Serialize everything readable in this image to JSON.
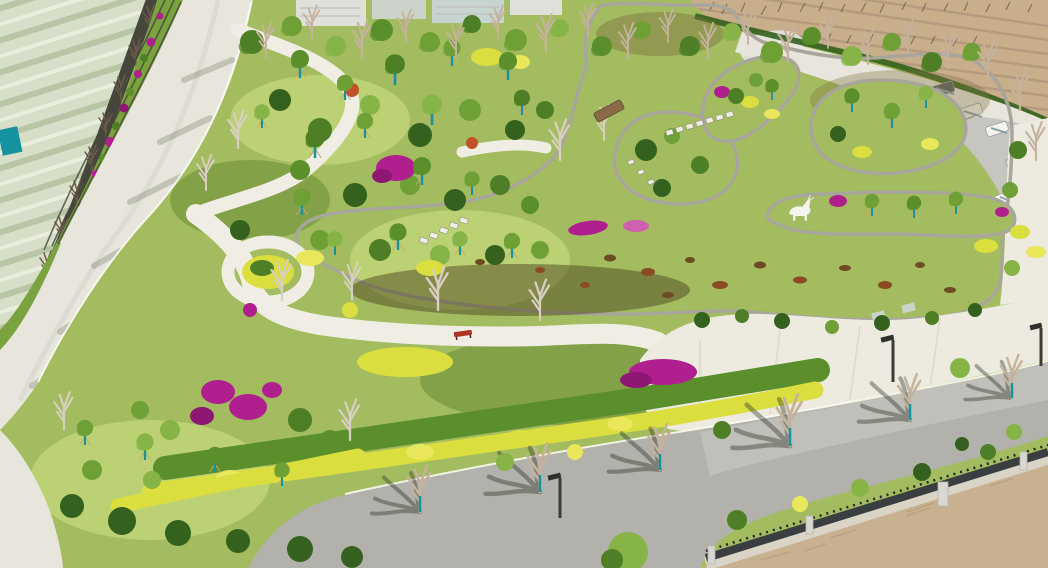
{
  "scene": {
    "title": "Aerial drone view of a newly landscaped pond garden park in spring",
    "description": "Bird's-eye photo of a public park: a curving brown pond with stone edging and planted islands, white looping footpaths, magenta bougainvillea and yellow hedges, young staked trees, a perimeter road on the left beside terraced flower beds and crop farmland, a bare dormant orchard field at upper right with a parking strip, an asphalt road with tree shadows at the bottom, and a dark metal boundary fence with concrete posts above bare dirt in the lower right corner.",
    "time_of_day": "bright daytime",
    "season": "early spring"
  },
  "landmarks": {
    "pond": "curved brown-water pond with grey stone rip-rap edging",
    "islands_count": 3,
    "wood_bridge_count": 1,
    "stepping_stone_crossings": 2,
    "deer_sculpture_count": 1,
    "red_bench_count": 1,
    "street_lamp_count": 3,
    "parked_vehicle_count": 5,
    "fence": "dark metal picket fence with light concrete posts",
    "farmland": "striped crop rows, upper left beyond dark wall",
    "orchard_field": "tan dormant field with bare saplings, upper right",
    "roads": [
      "left perimeter road",
      "bottom asphalt road",
      "upper-right service road with parking"
    ]
  },
  "palette": {
    "lawn": "#a4bc60",
    "lawnLight": "#bcd173",
    "lawnDark": "#83a146",
    "canopyA": "#4e7f26",
    "canopyB": "#6fa035",
    "canopyC": "#86b447",
    "canopyD": "#5a8f2b",
    "bushDark": "#34611d",
    "yellow": "#dade3f",
    "yellowLight": "#e9e75b",
    "magenta": "#b01f8e",
    "magentaDark": "#8d1773",
    "pink": "#d060b0",
    "red": "#c2502a",
    "water": "#6b5e2f",
    "waterDark": "#4e4620",
    "waterLight": "#7d7040",
    "lily": "#6b4a24",
    "lilyRed": "#8a4a22",
    "stone": "#a8a69a",
    "stoneDark": "#8f8d82",
    "pathLight": "#f0eee4",
    "roadLight": "#e8e6dc",
    "asphalt": "#b2b1ac",
    "asphaltLight": "#c6c5c0",
    "plaza": "#edebe0",
    "field": "#c9ae8c",
    "fieldRow": "#b2977a",
    "farm": "#d8dfc9",
    "farmRow": "#b9c6a6",
    "farmLight": "#eaeedd",
    "terrace": "#7aa23e",
    "wall": "#45463c",
    "teal": "#15939f",
    "cane": "#c8a76c",
    "twigLight": "#c4b29c",
    "twigDark": "#6e5c48",
    "trunkWhite": "#d8cfc2",
    "fenceDark": "#3a3e40",
    "fencePost": "#d8d7d1",
    "fenceBase": "#d9d4c6",
    "dirt": "#c7b191",
    "building": "#dfe0da",
    "buildingB": "#ccd3cb",
    "glass": "#c8d4d2",
    "bridge": "#8a6b48",
    "white": "#f4f3ee",
    "shadow": "rgba(38,45,32,0.38)"
  }
}
